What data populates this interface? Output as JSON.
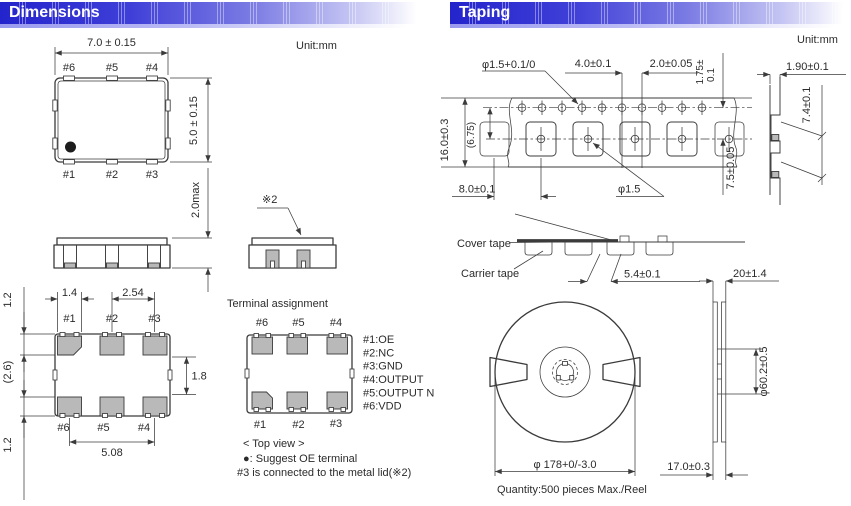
{
  "header": {
    "left": "Dimensions",
    "right": "Taping"
  },
  "colors": {
    "header_blue": "#2424cc",
    "pad_gray": "#b9b9b9",
    "line": "#3b3b3b"
  },
  "dimensions": {
    "unit": "Unit:mm",
    "top_view": {
      "width_dim": "7.0 ± 0.15",
      "height_dim": "5.0 ± 0.15",
      "depth_dim": "2.0max",
      "pins_top": [
        "#6",
        "#5",
        "#4"
      ],
      "pins_bottom": [
        "#1",
        "#2",
        "#3"
      ]
    },
    "side_view": {
      "lid_note": "※2"
    },
    "bottom_view": {
      "pad_width": "1.4",
      "pad_pitch": "2.54",
      "margin_top": "1.2",
      "margin_mid": "(2.6)",
      "margin_bottom": "1.2",
      "pad_gap": "1.8",
      "span": "5.08",
      "pins_top": [
        "#1",
        "#2",
        "#3"
      ],
      "pins_bottom": [
        "#6",
        "#5",
        "#4"
      ]
    },
    "terminal_assignment": {
      "title": "Terminal assignment",
      "pins_top": [
        "#6",
        "#5",
        "#4"
      ],
      "pins_bottom": [
        "#1",
        "#2",
        "#3"
      ],
      "list": [
        "#1:OE",
        "#2:NC",
        "#3:GND",
        "#4:OUTPUT",
        "#5:OUTPUT N",
        "#6:VDD"
      ],
      "view_caption": "< Top view >",
      "oe_note": "●: Suggest OE terminal",
      "lid_note": "#3 is connected to the metal lid(※2)"
    }
  },
  "taping": {
    "unit": "Unit:mm",
    "tape_top_view": {
      "sprocket_dia": "φ1.5+0.1/0",
      "hole_pitch": "4.0±0.1",
      "hole_offset": "2.0±0.05",
      "edge_margin": [
        "1.75±",
        "0.1"
      ],
      "tape_width": "16.0±0.3",
      "ref_dim": "(6.75)",
      "pocket_pitch": "8.0±0.1",
      "pocket_hole": "φ1.5",
      "pocket_offset": "7.5±0.05"
    },
    "tape_side_view": {
      "thickness": "1.90±0.1",
      "height": "7.4±0.1"
    },
    "tape_section": {
      "cover": "Cover tape",
      "carrier": "Carrier tape",
      "pocket_len": "5.4±0.1"
    },
    "reel": {
      "outer_dia": "φ 178+0/-3.0",
      "hub_dia": "φ60.2±0.5",
      "width": "20±1.4",
      "inner_width": "17.0±0.3",
      "quantity": "Quantity:500 pieces Max./Reel"
    }
  }
}
